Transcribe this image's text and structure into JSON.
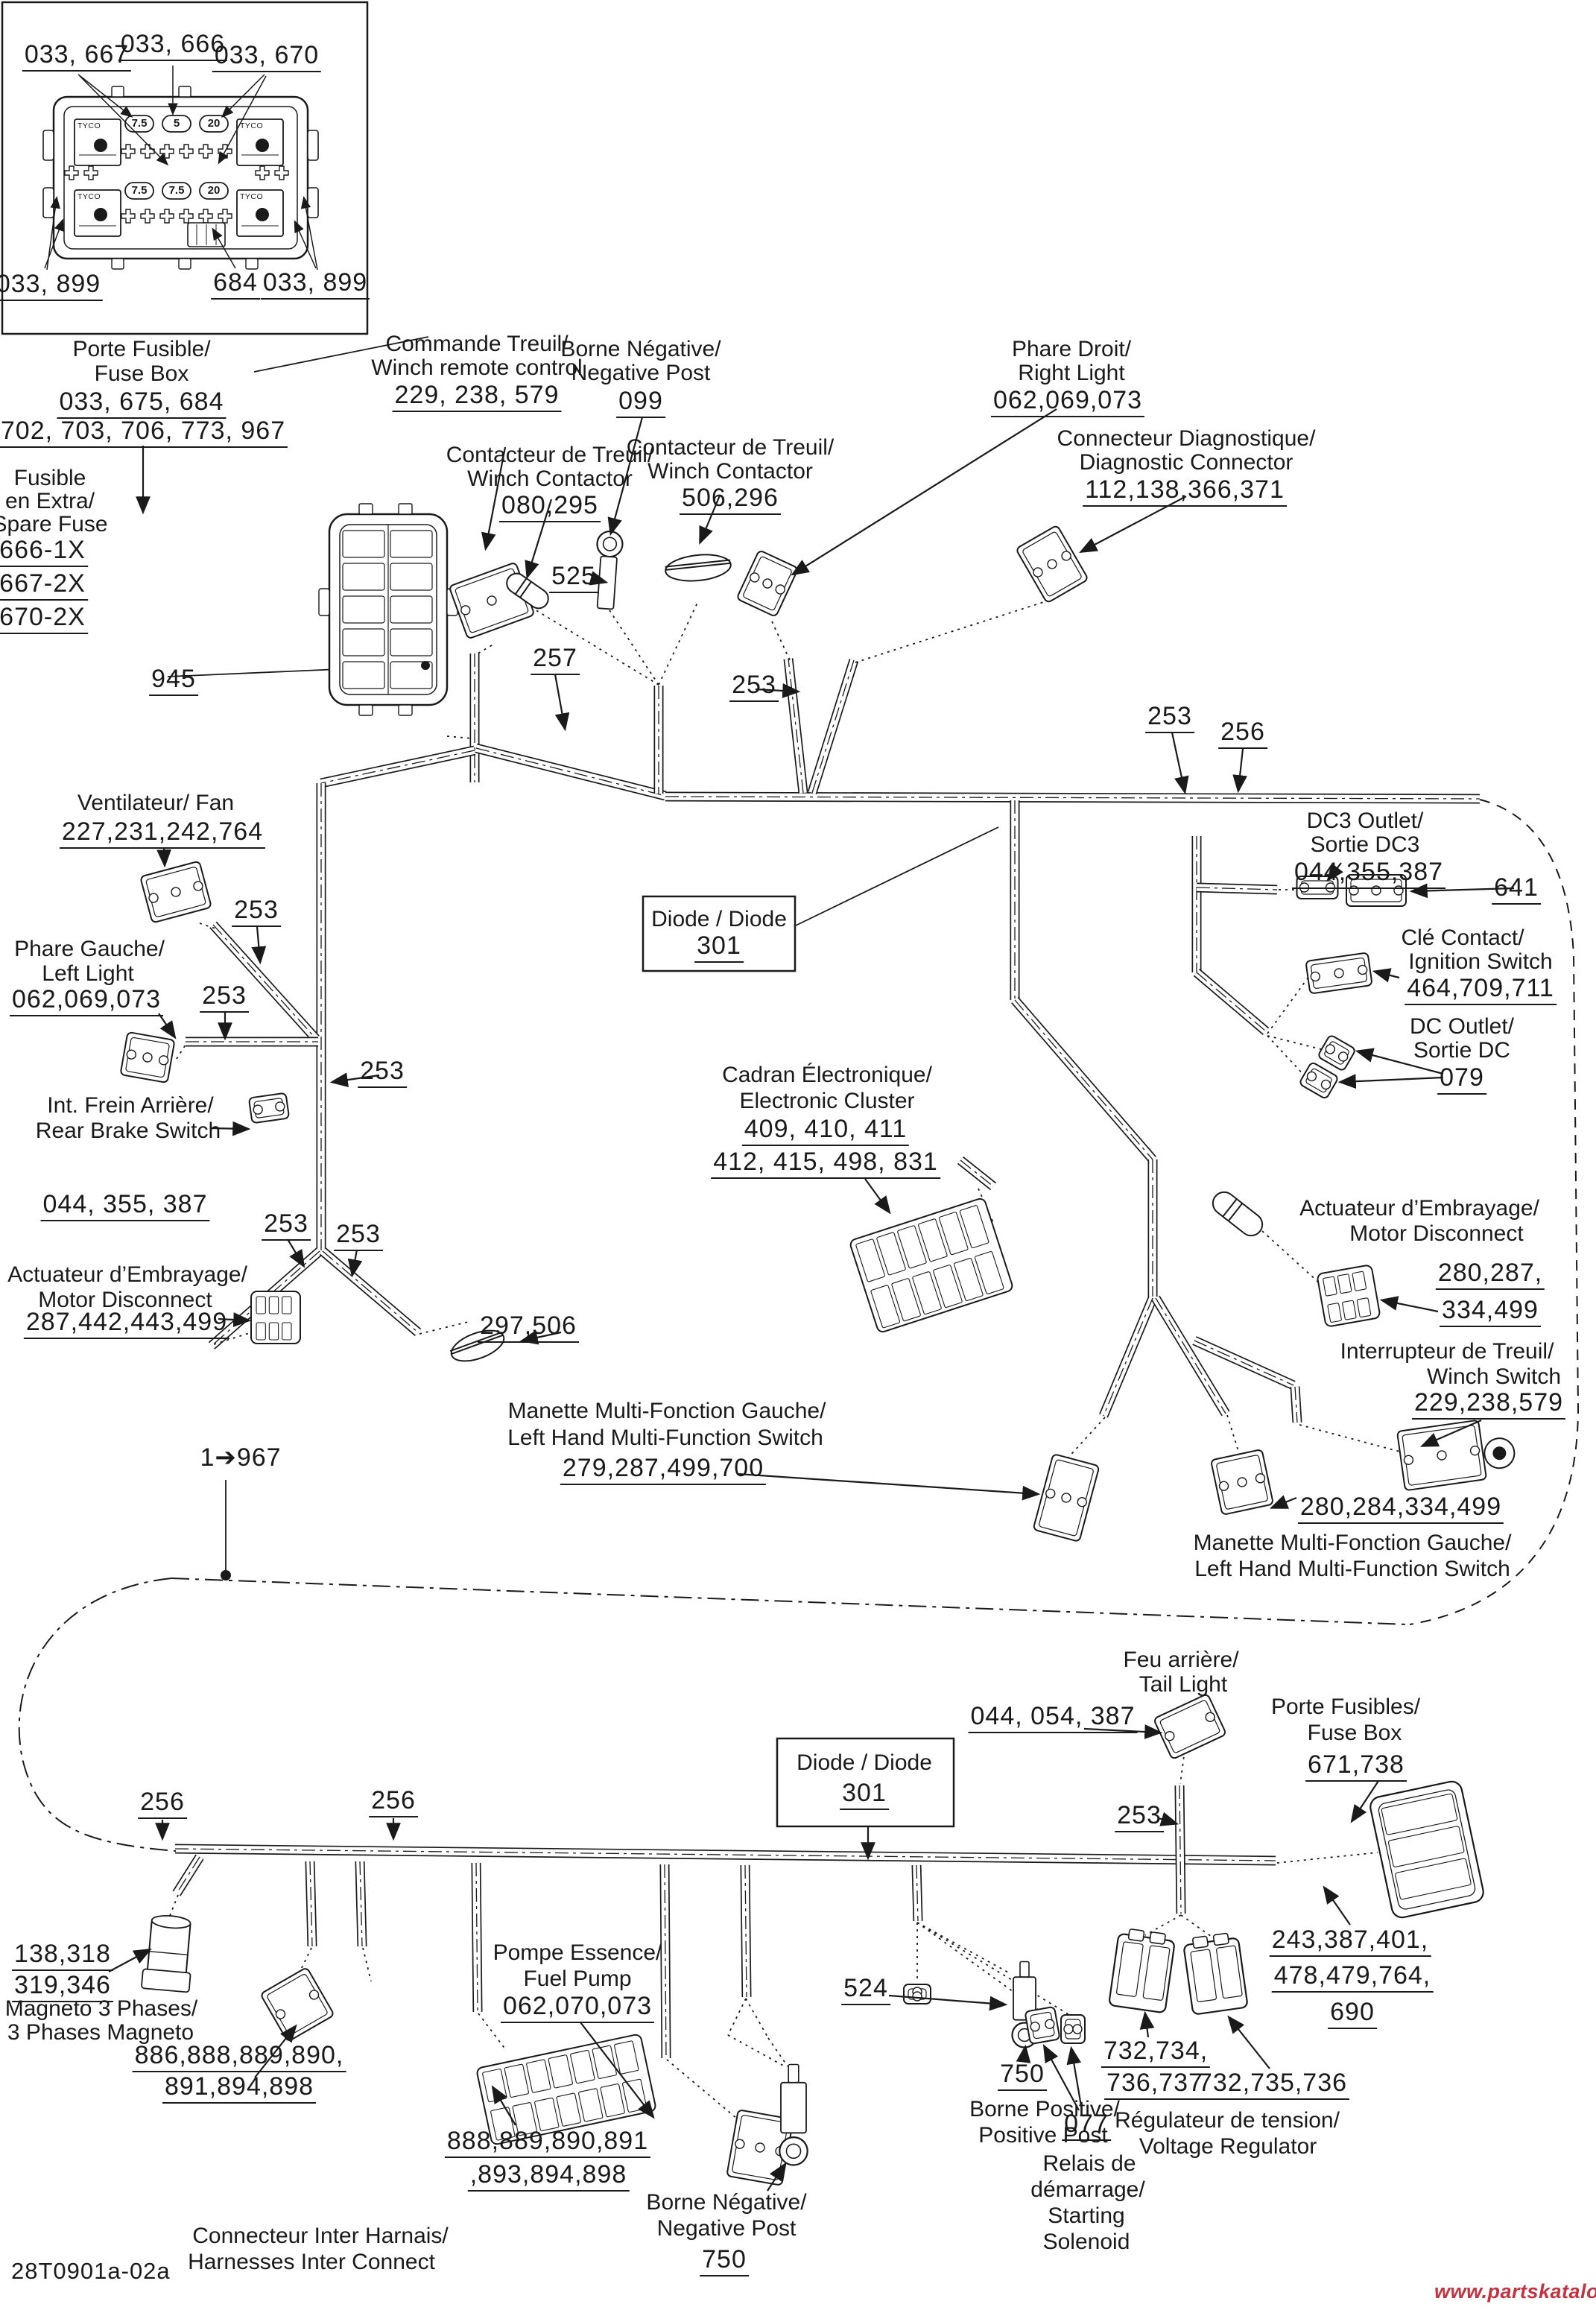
{
  "t": {
    "fd_667": "033, 667",
    "fd_666": "033, 666",
    "fd_670": "033, 670",
    "fd_899L": "033, 899",
    "fd_684": "684",
    "fd_899R": "033, 899",
    "pf_fr": "Porte Fusible/",
    "pf_en": "Fuse Box",
    "pf_n1": "033, 675, 684",
    "pf_n2": "702, 703, 706, 773, 967",
    "fe_1": "Fusible",
    "fe_2": "en Extra/",
    "fe_3": "Spare Fuse",
    "fe_n1": "666-1X",
    "fe_n2": "667-2X",
    "fe_n3": "670-2X",
    "n945": "945",
    "ct_fr": "Commande Treuil/",
    "ct_en": "Winch remote control",
    "ct_n": "229, 238, 579",
    "bn_fr": "Borne Négative/",
    "bn_en": "Negative Post",
    "bn_n": "099",
    "wc1_fr": "Contacteur de Treuil/",
    "wc1_en": "Winch Contactor",
    "wc1_n": "080,295",
    "wc2_fr": "Contacteur de Treuil/",
    "wc2_en": "Winch Contactor",
    "wc2_n": "506,296",
    "pd_fr": "Phare Droit/",
    "pd_en": "Right Light",
    "pd_n": "062,069,073",
    "dg_fr": "Connecteur Diagnostique/",
    "dg_en": "Diagnostic Connector",
    "dg_n": "112,138,366,371",
    "n525": "525",
    "n257": "257",
    "n253": "253",
    "n256": "256",
    "n641": "641",
    "vf_fr": "Ventilateur/ Fan",
    "vf_n": "227,231,242,764",
    "pg_fr": "Phare Gauche/",
    "pg_en": "Left Light",
    "pg_n": "062,069,073",
    "di_t": "Diode / Diode",
    "di_n": "301",
    "dc3_en": "DC3 Outlet/",
    "dc3_fr": "Sortie DC3",
    "dc3_n": "044,355,387",
    "cc_fr": "Clé Contact/",
    "cc_en": "Ignition Switch",
    "cc_n": "464,709,711",
    "dco_en": "DC Outlet/",
    "dco_fr": "Sortie DC",
    "dco_n": "079",
    "amr_fr": "Actuateur d’Embrayage/",
    "amr_en": "Motor Disconnect",
    "amr_n1": "280,287,",
    "amr_n2": "334,499",
    "it_fr": "Interrupteur de Treuil/",
    "it_en": "Winch Switch",
    "it_n": "229,238,579",
    "n280284": "280,284,334,499",
    "mm_fr": "Manette Multi-Fonction Gauche/",
    "mm_en": "Left Hand Multi-Function Switch",
    "ml_n": "279,287,499,700",
    "n297": "297,506",
    "ce_fr": "Cadran Électronique/",
    "ce_en": "Electronic Cluster",
    "ce_n1": "409, 410, 411",
    "ce_n2": "412, 415, 498, 831",
    "aml_fr": "Actuateur d’Embrayage/",
    "aml_en": "Motor Disconnect",
    "aml_n": "287,442,443,499",
    "rb_fr": "Int. Frein Arrière/",
    "rb_en": "Rear Brake Switch",
    "rb_n": "044, 355, 387",
    "n1967": "1➔967",
    "fa_fr": "Feu arrière/",
    "fa_en": "Tail Light",
    "fa_n": "044, 054, 387",
    "pfr_fr": "Porte Fusibles/",
    "pfr_en": "Fuse Box",
    "pfr_n": "671,738",
    "rfx_n1": "243,387,401,",
    "rfx_n2": "478,479,764,",
    "rfx_n3": "690",
    "mg_n1": "138,318",
    "mg_n2": "319,346",
    "mg_fr": "Magneto 3 Phases/",
    "mg_en": "3 Phases Magneto",
    "ic1_n1": "886,888,889,890,",
    "ic1_n2": "891,894,898",
    "ic2_n1": "888,889,890,891",
    "ic2_n2": ",893,894,898",
    "ic_fr": "Connecteur Inter Harnais/",
    "ic_en": "Harnesses Inter Connect",
    "fp_fr": "Pompe Essence/",
    "fp_en": "Fuel Pump",
    "fp_n": "062,070,073",
    "n524": "524",
    "bp_n": "750",
    "bp_fr": "Borne Positive/",
    "bp_en": "Positive Post",
    "bnb_fr": "Borne Négative/",
    "bnb_en": "Negative Post",
    "bnb_n": "750",
    "n077": "077",
    "rs_1": "Relais de",
    "rs_2": "démarrage/",
    "rs_3": "Starting",
    "rs_4": "Solenoid",
    "vr_n1": "732,734,",
    "vr_n2": "736,737",
    "vr_n3": "732,735,736",
    "vr_fr": "Régulateur de tension/",
    "vr_en": "Voltage Regulator",
    "id_code": "28T0901a-02a",
    "watermark": "www.partskatalog.ru"
  },
  "fuse": {
    "brand": "TYCO",
    "vals": [
      "7.5",
      "5",
      "20",
      "7.5",
      "7.5",
      "20"
    ]
  },
  "colors": {
    "line": "#1a1a1a",
    "watermark": "#c5323f",
    "background": "#ffffff"
  }
}
